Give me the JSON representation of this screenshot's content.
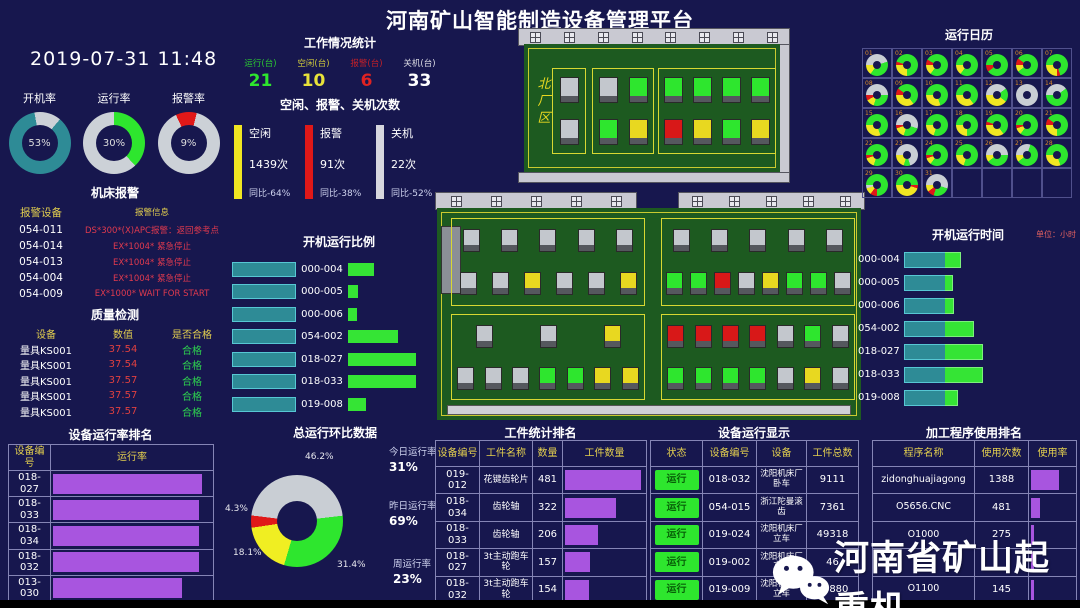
{
  "header": {
    "title": "河南矿山智能制造设备管理平台",
    "datetime": "2019-07-31 11:48"
  },
  "gauges": [
    {
      "label": "开机率",
      "value": "53",
      "unit": "%",
      "color": "#2e8b96",
      "pct": 86,
      "from": 40
    },
    {
      "label": "运行率",
      "value": "30",
      "unit": "%",
      "color": "#2ee62e",
      "pct": 38,
      "from": 0
    },
    {
      "label": "报警率",
      "value": "9",
      "unit": "%",
      "color": "#e01818",
      "pct": 11,
      "from": -25
    }
  ],
  "work_stats": {
    "title": "工作情况统计",
    "items": [
      {
        "label": "运行(台)",
        "value": "21",
        "color": "#2ee62e"
      },
      {
        "label": "空闲(台)",
        "value": "10",
        "color": "#e8e23a"
      },
      {
        "label": "报警(台)",
        "value": "6",
        "color": "#e02222"
      },
      {
        "label": "关机(台)",
        "value": "33",
        "color": "#ffffff"
      }
    ]
  },
  "counts": {
    "title": "空闲、报警、关机次数",
    "items": [
      {
        "label": "空闲",
        "count": "1439次",
        "yoy": "同比-64%",
        "color": "#f0e622"
      },
      {
        "label": "报警",
        "count": "91次",
        "yoy": "同比-38%",
        "color": "#e01818"
      },
      {
        "label": "关机",
        "count": "22次",
        "yoy": "同比-52%",
        "color": "#d7d7de"
      }
    ]
  },
  "alarm": {
    "title": "机床报警",
    "col_device": "报警设备",
    "col_info": "报警信息",
    "rows": [
      {
        "device": "054-011",
        "info": "DS*300*(X)APC报警：返回参考点"
      },
      {
        "device": "054-014",
        "info": "EX*1004* 紧急停止"
      },
      {
        "device": "054-013",
        "info": "EX*1004* 紧急停止"
      },
      {
        "device": "054-004",
        "info": "EX*1004* 紧急停止"
      },
      {
        "device": "054-009",
        "info": "EX*1000* WAIT FOR START"
      }
    ]
  },
  "quality": {
    "title": "质量检测",
    "headers": [
      "设备",
      "数值",
      "是否合格"
    ],
    "rows": [
      {
        "device": "量具KS001",
        "value": "37.54",
        "result": "合格"
      },
      {
        "device": "量具KS001",
        "value": "37.54",
        "result": "合格"
      },
      {
        "device": "量具KS001",
        "value": "37.57",
        "result": "合格"
      },
      {
        "device": "量具KS001",
        "value": "37.57",
        "result": "合格"
      },
      {
        "device": "量具KS001",
        "value": "37.57",
        "result": "合格"
      }
    ]
  },
  "rate_rank": {
    "title": "设备运行率排名",
    "headers": [
      "设备编号",
      "运行率"
    ],
    "rows": [
      {
        "id": "018-027",
        "pct": 94
      },
      {
        "id": "018-033",
        "pct": 92
      },
      {
        "id": "018-034",
        "pct": 92
      },
      {
        "id": "018-032",
        "pct": 92
      },
      {
        "id": "013-030",
        "pct": 81
      }
    ]
  },
  "ratio_chart": {
    "title": "开机运行比例",
    "rows": [
      {
        "id": "000-004",
        "left": 62,
        "right": 26
      },
      {
        "id": "000-005",
        "left": 62,
        "right": 10
      },
      {
        "id": "000-006",
        "left": 62,
        "right": 9
      },
      {
        "id": "054-002",
        "left": 62,
        "right": 50
      },
      {
        "id": "018-027",
        "left": 62,
        "right": 68
      },
      {
        "id": "018-033",
        "left": 62,
        "right": 68
      },
      {
        "id": "019-008",
        "left": 62,
        "right": 18
      }
    ]
  },
  "hb": {
    "title": "总运行环比数据",
    "slices": [
      {
        "label": "46.2%",
        "value": 46.2,
        "color": "#c9ced4"
      },
      {
        "label": "31.4%",
        "value": 31.4,
        "color": "#2ee62e"
      },
      {
        "label": "18.1%",
        "value": 18.1,
        "color": "#f0ee22"
      },
      {
        "label": "4.3%",
        "value": 4.3,
        "color": "#e01818"
      }
    ],
    "stats": [
      {
        "label": "今日运行率",
        "value": "31%"
      },
      {
        "label": "昨日运行率",
        "value": "69%"
      },
      {
        "label": "周运行率",
        "value": "23%"
      }
    ]
  },
  "factory": {
    "north": {
      "label": "北厂区",
      "groups": [
        {
          "rows": [
            [
              "gray"
            ],
            [
              "gray"
            ]
          ]
        },
        {
          "rows": [
            [
              "gray",
              "green"
            ],
            [
              "green",
              "yellow"
            ]
          ]
        },
        {
          "rows": [
            [
              "green",
              "green",
              "green",
              "green"
            ],
            [
              "red",
              "yellow",
              "green",
              "yellow"
            ]
          ]
        }
      ]
    },
    "main": {
      "zones": [
        {
          "pos": "tl",
          "rows": [
            [
              "gray",
              "gray",
              "gray",
              "gray",
              "gray"
            ],
            [
              "gray",
              "gray",
              "yellow",
              "gray",
              "gray",
              "yellow"
            ]
          ]
        },
        {
          "pos": "tr",
          "rows": [
            [
              "gray",
              "gray",
              "gray",
              "gray",
              "gray"
            ],
            [
              "green",
              "green",
              "red",
              "gray",
              "yellow",
              "green",
              "green",
              "gray"
            ]
          ]
        },
        {
          "pos": "bl",
          "rows": [
            [
              "gray",
              "gray",
              "yellow"
            ],
            [
              "gray",
              "gray",
              "gray",
              "green",
              "green",
              "yellow",
              "yellow"
            ]
          ]
        },
        {
          "pos": "br",
          "rows": [
            [
              "red",
              "red",
              "red",
              "red",
              "gray",
              "green",
              "gray"
            ],
            [
              "green",
              "green",
              "green",
              "green",
              "gray",
              "yellow",
              "gray"
            ]
          ]
        }
      ]
    }
  },
  "calendar": {
    "title": "运行日历",
    "days": [
      {
        "d": "01",
        "s": [
          [
            "A",
            45
          ],
          [
            "G",
            40
          ],
          [
            "Y",
            15
          ]
        ]
      },
      {
        "d": "02",
        "s": [
          [
            "R",
            5
          ],
          [
            "G",
            70
          ],
          [
            "Y",
            25
          ]
        ]
      },
      {
        "d": "03",
        "s": [
          [
            "R",
            8
          ],
          [
            "G",
            77
          ],
          [
            "Y",
            15
          ]
        ]
      },
      {
        "d": "04",
        "s": [
          [
            "G",
            85
          ],
          [
            "Y",
            15
          ]
        ]
      },
      {
        "d": "05",
        "s": [
          [
            "G",
            90
          ],
          [
            "R",
            10
          ]
        ]
      },
      {
        "d": "06",
        "s": [
          [
            "R",
            10
          ],
          [
            "G",
            80
          ],
          [
            "Y",
            10
          ]
        ]
      },
      {
        "d": "07",
        "s": [
          [
            "G",
            70
          ],
          [
            "R",
            5
          ],
          [
            "Y",
            25
          ]
        ]
      },
      {
        "d": "08",
        "s": [
          [
            "A",
            50
          ],
          [
            "G",
            30
          ],
          [
            "Y",
            12
          ],
          [
            "R",
            8
          ]
        ]
      },
      {
        "d": "09",
        "s": [
          [
            "R",
            10
          ],
          [
            "G",
            55
          ],
          [
            "Y",
            35
          ]
        ]
      },
      {
        "d": "10",
        "s": [
          [
            "G",
            70
          ],
          [
            "Y",
            30
          ]
        ]
      },
      {
        "d": "11",
        "s": [
          [
            "G",
            65
          ],
          [
            "Y",
            35
          ]
        ]
      },
      {
        "d": "12",
        "s": [
          [
            "A",
            40
          ],
          [
            "G",
            20
          ],
          [
            "Y",
            40
          ]
        ]
      },
      {
        "d": "13",
        "s": [
          [
            "A",
            100
          ]
        ]
      },
      {
        "d": "14",
        "s": [
          [
            "A",
            40
          ],
          [
            "G",
            60
          ]
        ]
      },
      {
        "d": "15",
        "s": [
          [
            "G",
            70
          ],
          [
            "Y",
            30
          ]
        ]
      },
      {
        "d": "16",
        "s": [
          [
            "A",
            55
          ],
          [
            "G",
            25
          ],
          [
            "Y",
            15
          ],
          [
            "R",
            5
          ]
        ]
      },
      {
        "d": "17",
        "s": [
          [
            "G",
            80
          ],
          [
            "Y",
            20
          ]
        ]
      },
      {
        "d": "18",
        "s": [
          [
            "G",
            75
          ],
          [
            "Y",
            25
          ]
        ]
      },
      {
        "d": "19",
        "s": [
          [
            "R",
            5
          ],
          [
            "G",
            60
          ],
          [
            "Y",
            35
          ]
        ]
      },
      {
        "d": "20",
        "s": [
          [
            "G",
            85
          ],
          [
            "Y",
            10
          ],
          [
            "R",
            5
          ]
        ]
      },
      {
        "d": "21",
        "s": [
          [
            "R",
            10
          ],
          [
            "G",
            65
          ],
          [
            "Y",
            25
          ]
        ]
      },
      {
        "d": "22",
        "s": [
          [
            "G",
            80
          ],
          [
            "Y",
            15
          ],
          [
            "R",
            5
          ]
        ]
      },
      {
        "d": "23",
        "s": [
          [
            "A",
            70
          ],
          [
            "G",
            10
          ],
          [
            "Y",
            20
          ]
        ]
      },
      {
        "d": "24",
        "s": [
          [
            "G",
            85
          ],
          [
            "Y",
            10
          ],
          [
            "R",
            5
          ]
        ]
      },
      {
        "d": "25",
        "s": [
          [
            "G",
            80
          ],
          [
            "Y",
            20
          ]
        ]
      },
      {
        "d": "26",
        "s": [
          [
            "A",
            50
          ],
          [
            "G",
            40
          ],
          [
            "Y",
            10
          ]
        ]
      },
      {
        "d": "27",
        "s": [
          [
            "A",
            30
          ],
          [
            "G",
            60
          ],
          [
            "Y",
            10
          ]
        ]
      },
      {
        "d": "28",
        "s": [
          [
            "G",
            70
          ],
          [
            "Y",
            30
          ]
        ]
      },
      {
        "d": "29",
        "s": [
          [
            "G",
            75
          ],
          [
            "R",
            10
          ],
          [
            "Y",
            10
          ],
          [
            "A",
            5
          ]
        ]
      },
      {
        "d": "30",
        "s": [
          [
            "G",
            50
          ],
          [
            "R",
            5
          ],
          [
            "Y",
            45
          ]
        ]
      },
      {
        "d": "31",
        "s": [
          [
            "A",
            55
          ],
          [
            "G",
            25
          ],
          [
            "R",
            10
          ],
          [
            "Y",
            10
          ]
        ]
      }
    ]
  },
  "time_chart": {
    "title": "开机运行时间",
    "unit": "单位：小时",
    "rows": [
      {
        "id": "000-004",
        "teal": 40,
        "green": 15
      },
      {
        "id": "000-005",
        "teal": 40,
        "green": 7
      },
      {
        "id": "000-006",
        "teal": 40,
        "green": 8
      },
      {
        "id": "054-002",
        "teal": 40,
        "green": 28
      },
      {
        "id": "018-027",
        "teal": 40,
        "green": 37
      },
      {
        "id": "018-033",
        "teal": 40,
        "green": 37
      },
      {
        "id": "019-008",
        "teal": 40,
        "green": 12
      }
    ]
  },
  "workpiece": {
    "title": "工件统计排名",
    "headers": [
      "设备编号",
      "工件名称",
      "数量",
      "工件数量"
    ],
    "rows": [
      {
        "id": "019-012",
        "name": "花键齿轮片",
        "count": "481",
        "bar": 95
      },
      {
        "id": "018-034",
        "name": "齿轮轴",
        "count": "322",
        "bar": 64
      },
      {
        "id": "018-033",
        "name": "齿轮轴",
        "count": "206",
        "bar": 41
      },
      {
        "id": "018-027",
        "name": "3t主动跑车轮",
        "count": "157",
        "bar": 31
      },
      {
        "id": "018-032",
        "name": "3t主动跑车轮",
        "count": "154",
        "bar": 30
      }
    ]
  },
  "device_display": {
    "title": "设备运行显示",
    "headers": [
      "状态",
      "设备编号",
      "设备",
      "工件总数"
    ],
    "status_label": "运行",
    "rows": [
      {
        "id": "018-032",
        "device": "沈阳机床厂卧车",
        "total": "9111"
      },
      {
        "id": "054-015",
        "device": "浙江陀曼滚齿",
        "total": "7361"
      },
      {
        "id": "019-024",
        "device": "沈阳机床厂立车",
        "total": "49318"
      },
      {
        "id": "019-002",
        "device": "沈阳机床厂立车",
        "total": "46"
      },
      {
        "id": "019-009",
        "device": "沈阳机床厂立车",
        "total": "44880"
      }
    ]
  },
  "program": {
    "title": "加工程序使用排名",
    "headers": [
      "程序名称",
      "使用次数",
      "使用率"
    ],
    "rows": [
      {
        "name": "zidonghuajiagong",
        "count": "1388",
        "bar": 64
      },
      {
        "name": "O5656.CNC",
        "count": "481",
        "bar": 20
      },
      {
        "name": "O1000",
        "count": "275",
        "bar": 7
      },
      {
        "name": "",
        "count": "",
        "bar": 6
      },
      {
        "name": "O1100",
        "count": "145",
        "bar": 6
      }
    ]
  },
  "watermark": {
    "text": "河南省矿山起重机"
  },
  "colors": {
    "machine": {
      "gray": "#c3c7cd",
      "green": "#2ee62e",
      "yellow": "#e8d820",
      "red": "#d81818"
    },
    "cal": {
      "G": "#2ee62e",
      "Y": "#f0e622",
      "R": "#e01818",
      "A": "#c9ced4"
    },
    "purple": "#a855df",
    "teal": "#2e8b96",
    "green_bar": "#35e435",
    "bg": "#17174e"
  },
  "chart_data": [
    {
      "type": "pie",
      "title": "开机率",
      "values": [
        53,
        47
      ],
      "labels": [
        "开机率",
        "其余"
      ]
    },
    {
      "type": "pie",
      "title": "运行率",
      "values": [
        30,
        70
      ],
      "labels": [
        "运行率",
        "其余"
      ]
    },
    {
      "type": "pie",
      "title": "报警率",
      "values": [
        9,
        91
      ],
      "labels": [
        "报警率",
        "其余"
      ]
    },
    {
      "type": "bar",
      "title": "空闲、报警、关机次数",
      "categories": [
        "空闲",
        "报警",
        "关机"
      ],
      "values": [
        1439,
        91,
        22
      ],
      "annotations": [
        "同比-64%",
        "同比-38%",
        "同比-52%"
      ]
    },
    {
      "type": "bar",
      "title": "设备运行率排名",
      "categories": [
        "018-027",
        "018-033",
        "018-034",
        "018-032",
        "013-030"
      ],
      "values_visual_pct": [
        94,
        92,
        92,
        92,
        81
      ]
    },
    {
      "type": "bar",
      "title": "开机运行比例",
      "categories": [
        "000-004",
        "000-005",
        "000-006",
        "054-002",
        "018-027",
        "018-033",
        "019-008"
      ],
      "series": [
        {
          "name": "开机",
          "visual_px": [
            62,
            62,
            62,
            62,
            62,
            62,
            62
          ]
        },
        {
          "name": "运行",
          "visual_px": [
            26,
            10,
            9,
            50,
            68,
            68,
            18
          ]
        }
      ]
    },
    {
      "type": "pie",
      "title": "总运行环比数据",
      "labels": [
        "灰",
        "绿",
        "黄",
        "红"
      ],
      "values": [
        46.2,
        31.4,
        18.1,
        4.3
      ],
      "annotations": {
        "今日运行率": "31%",
        "昨日运行率": "69%",
        "周运行率": "23%"
      }
    },
    {
      "type": "bar",
      "title": "开机运行时间",
      "unit": "小时",
      "categories": [
        "000-004",
        "000-005",
        "000-006",
        "054-002",
        "018-027",
        "018-033",
        "019-008"
      ],
      "series": [
        {
          "name": "开机",
          "visual_px": [
            40,
            40,
            40,
            40,
            40,
            40,
            40
          ]
        },
        {
          "name": "运行",
          "visual_px": [
            15,
            7,
            8,
            28,
            37,
            37,
            12
          ]
        }
      ]
    },
    {
      "type": "bar",
      "title": "工件统计排名",
      "categories": [
        "019-012",
        "018-034",
        "018-033",
        "018-027",
        "018-032"
      ],
      "values": [
        481,
        322,
        206,
        157,
        154
      ]
    },
    {
      "type": "bar",
      "title": "加工程序使用排名",
      "categories": [
        "zidonghuajiagong",
        "O5656.CNC",
        "O1000",
        "",
        "O1100"
      ],
      "values": [
        1388,
        481,
        275,
        null,
        145
      ]
    }
  ]
}
